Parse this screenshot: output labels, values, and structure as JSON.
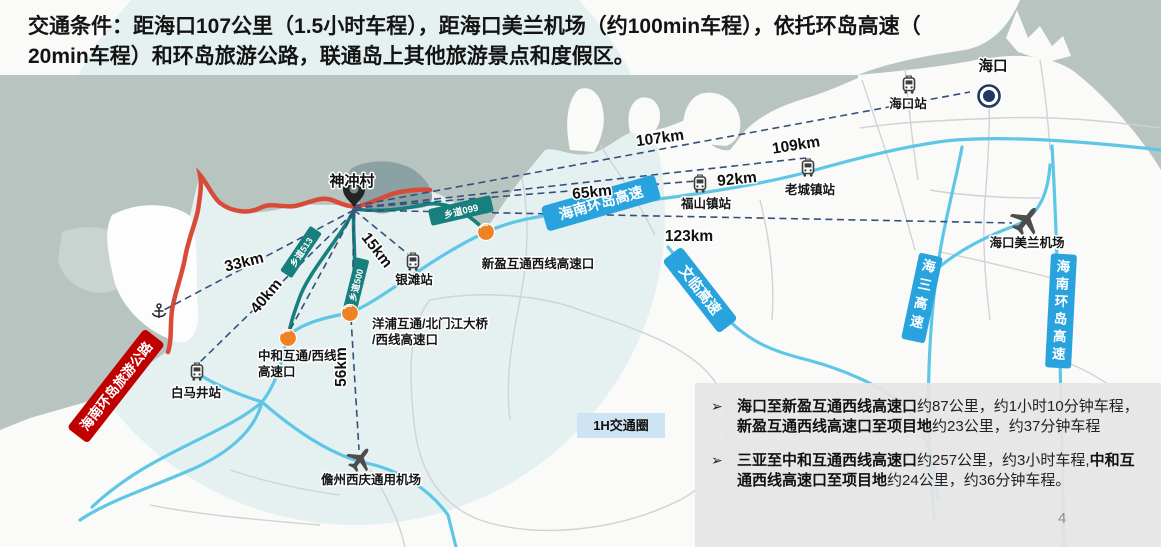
{
  "title": {
    "lines": [
      "交通条件：距海口107公里（1.5小时车程），距海口美兰机场（约100min车程），依托环岛高速（",
      "20min车程）和环岛旅游公路，联通岛上其他旅游景点和度假区。"
    ]
  },
  "page_number": "4",
  "map": {
    "city": "海口",
    "village": "神冲村",
    "circle_label": "1H交通圈",
    "stations": [
      {
        "label": "海口站"
      },
      {
        "label": "老城镇站"
      },
      {
        "label": "福山镇站"
      },
      {
        "label": "银滩站"
      },
      {
        "label": "白马井站"
      }
    ],
    "airports": {
      "meilan": "海口美兰机场",
      "danzhou": "儋州西庆通用机场"
    },
    "interchanges": {
      "xinying": "新盈互通西线高速口",
      "zhonghe_l1": "中和互通/西线",
      "zhonghe_l2": "高速口",
      "yangpu_l1": "洋浦互通/北门江大桥",
      "yangpu_l2": "/西线高速口"
    },
    "distances": [
      {
        "label": "107km"
      },
      {
        "label": "109km"
      },
      {
        "label": "92km"
      },
      {
        "label": "65km"
      },
      {
        "label": "123km"
      },
      {
        "label": "33km"
      },
      {
        "label": "40km"
      },
      {
        "label": "15km"
      },
      {
        "label": "56km"
      }
    ],
    "badges": {
      "ring_main": "海南环岛高速",
      "wenlin": "文临高速",
      "haisan": "海三高速",
      "ring_east": "海南环岛高速",
      "tourism": "海南环岛旅游公路",
      "x099": "乡道099",
      "x513": "乡道513",
      "x500": "乡道500"
    },
    "icons": [
      "train-icon",
      "plane-icon",
      "anchor-icon",
      "location-pin-icon",
      "city-marker-icon",
      "interchange-dot-icon"
    ]
  },
  "info_box": {
    "bullet_char": "➢",
    "bullets": [
      {
        "segments": [
          {
            "t": "海口至新盈互通西线高速口",
            "b": true
          },
          {
            "t": "约87公里，约1小时10分钟车程，",
            "b": false
          },
          {
            "t": "新盈互通西线高速口至项目地",
            "b": true
          },
          {
            "t": "约23公里，约37分钟车程",
            "b": false
          }
        ]
      },
      {
        "segments": [
          {
            "t": "三亚至中和互通西线高速口",
            "b": true
          },
          {
            "t": "约257公里，约3小时车程,",
            "b": false
          },
          {
            "t": "中和互通西线高速口至项目地",
            "b": true
          },
          {
            "t": "约24公里，约36分钟车程。",
            "b": false
          }
        ]
      }
    ]
  },
  "colors": {
    "sea": "#b7c4c0",
    "land": "#fafaf8",
    "hour_circle": "#cfe5ea",
    "road_blue": "#5ec7e6",
    "road_teal": "#177f7c",
    "road_red": "#d84b38",
    "badge_blue": "#29a3dd",
    "badge_red": "#bf0000",
    "dash_navy": "#35507c",
    "interchange_orange": "#ef8222",
    "city_navy": "#203864",
    "infobox_bg": "#e7e6e6"
  }
}
